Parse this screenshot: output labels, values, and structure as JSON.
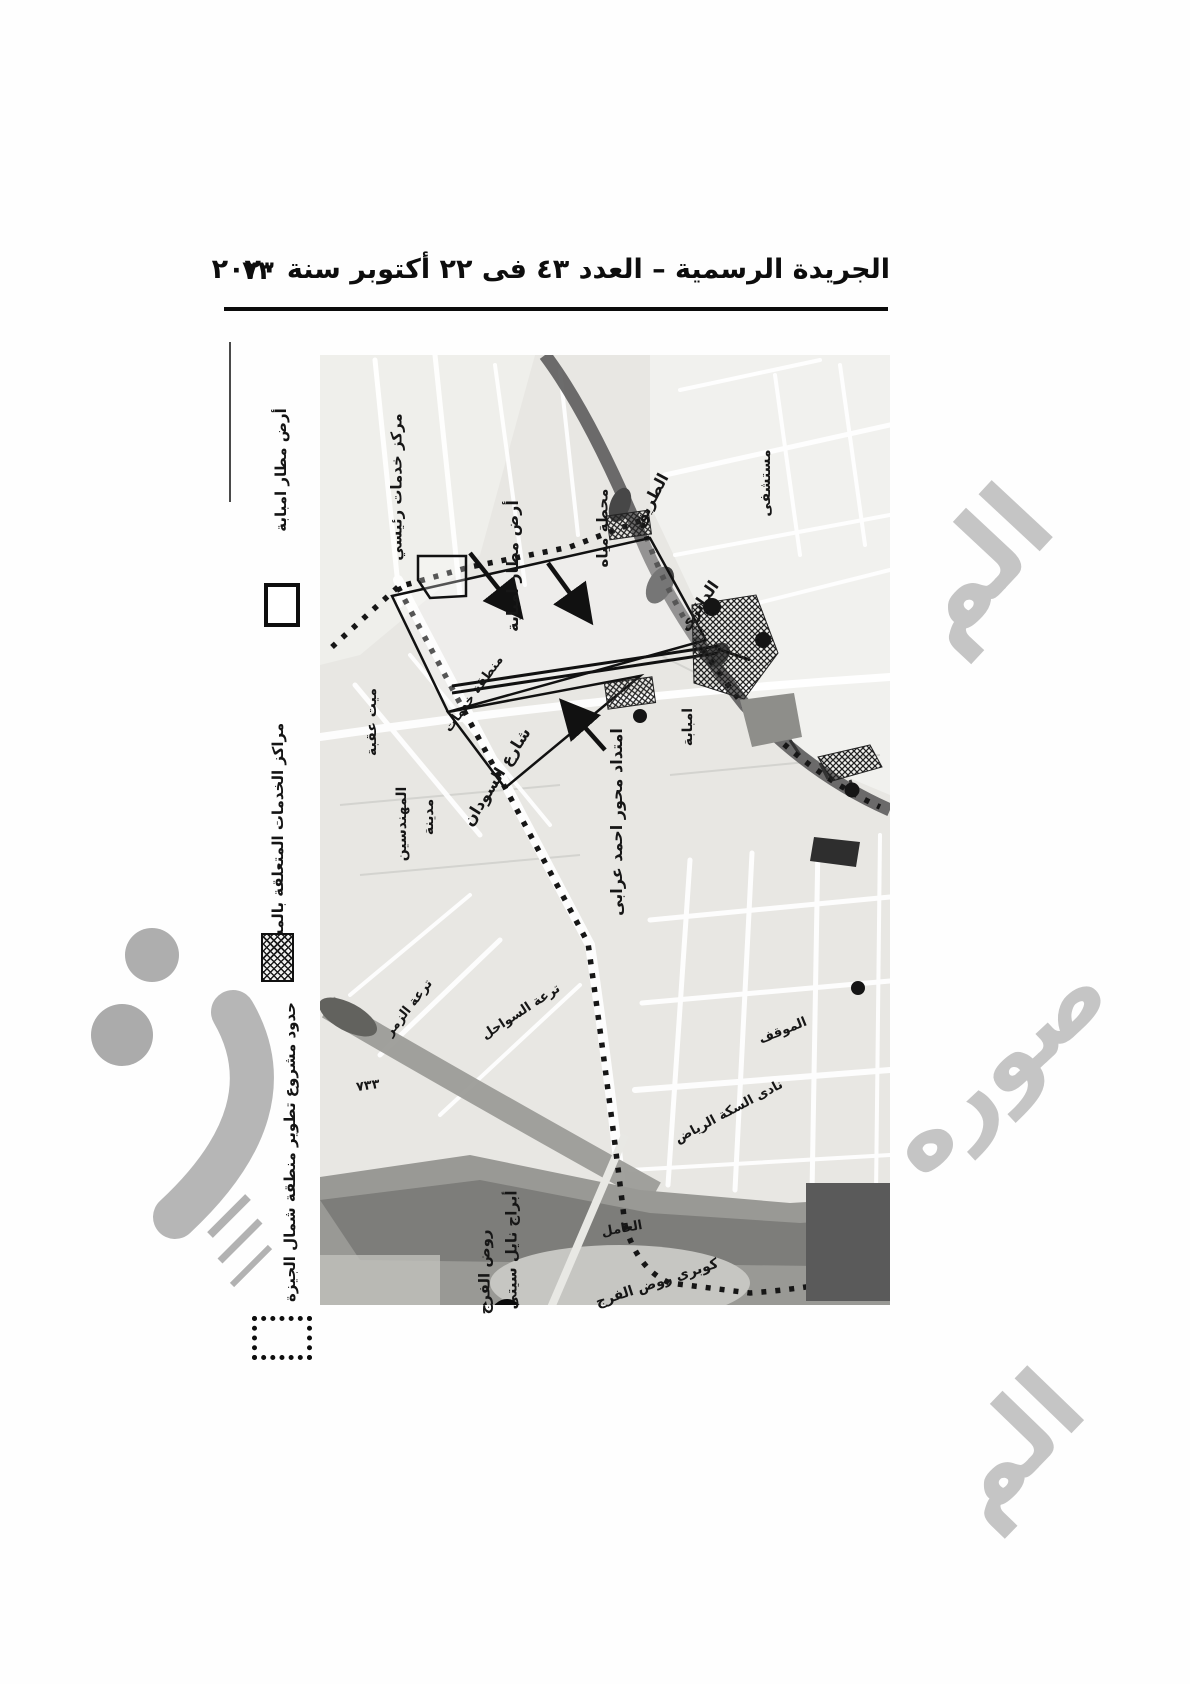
{
  "header": {
    "title": "الجريدة الرسمية – العدد ٤٣ فى ٢٢ أكتوبر سنة ٢٠٢٠",
    "page_number": "٧٣"
  },
  "legend": {
    "items": [
      {
        "label": "أرض مطار امبابة",
        "symbol": "white-square"
      },
      {
        "label": "مراكز الخدمات المتعلقة بالمشروع",
        "symbol": "hatched-square"
      },
      {
        "label": "حدود مشروع تطوير منطقة شمال الجيزة",
        "symbol": "dotted-square"
      }
    ]
  },
  "map": {
    "labels": [
      {
        "text": "مركز خدمات رئيسي"
      },
      {
        "text": "أرض مطار امبابة"
      },
      {
        "text": "محطة مياه"
      },
      {
        "text": "الطريق"
      },
      {
        "text": "الدائرى"
      },
      {
        "text": "مستشفى"
      },
      {
        "text": "منطقة خدمات"
      },
      {
        "text": "امتداد محور احمد عرابى"
      },
      {
        "text": "امبابة"
      },
      {
        "text": "شارع السودان"
      },
      {
        "text": "ميت عقبة"
      },
      {
        "text": "مدينة"
      },
      {
        "text": "المهندسين"
      },
      {
        "text": "ترعة الزمر"
      },
      {
        "text": "ترعة السواحل"
      },
      {
        "text": "الموقف"
      },
      {
        "text": "نادى السكة الرياض"
      },
      {
        "text": "العامل"
      },
      {
        "text": "كوبرى روض الفرج"
      },
      {
        "text": "أبراج نايل سيتى"
      },
      {
        "text": "روض الفرج"
      },
      {
        "text": "٧٣٣"
      }
    ]
  },
  "watermark": {
    "top_right": "الم",
    "bottom_right_1": "صوره",
    "bottom_right_2": "الم",
    "color": "#b7b7b7"
  },
  "colors": {
    "map_base": "#e8e7e3",
    "ring_road": "#5f5f5f",
    "river": "#8f8f8b",
    "boundary": "#161616"
  }
}
